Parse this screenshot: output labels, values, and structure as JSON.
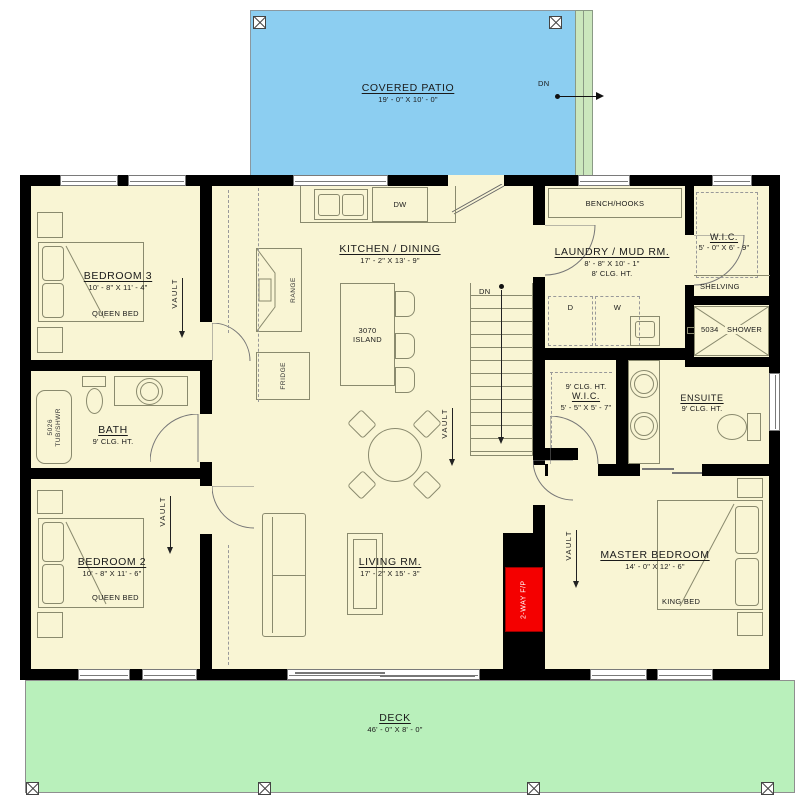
{
  "patio": {
    "name": "COVERED PATIO",
    "dims": "19' - 0\" X 10' - 0\"",
    "down_label": "DN"
  },
  "deck": {
    "name": "DECK",
    "dims": "46' - 0\" X 8' - 0\""
  },
  "house": {
    "bedroom3": {
      "name": "BEDROOM 3",
      "dims": "10' - 8\" X 11' - 4\"",
      "bed": "QUEEN BED"
    },
    "bath": {
      "name": "BATH",
      "ceiling": "9' CLG. HT.",
      "tub_model": "5026",
      "tub_type": "TUB/SHWR"
    },
    "bedroom2": {
      "name": "BEDROOM 2",
      "dims": "10' - 8\" X 11' - 6\"",
      "bed": "QUEEN BED"
    },
    "kitchen": {
      "name": "KITCHEN / DINING",
      "dims": "17' - 2\" X 13' - 9\"",
      "island_model": "3070",
      "island_label": "ISLAND",
      "dishwasher": "DW",
      "fridge": "FRIDGE",
      "range": "RANGE",
      "down_label": "DN"
    },
    "laundry": {
      "name": "LAUNDRY / MUD RM.",
      "dims": "8' - 8\" X 10' - 1\"",
      "ceiling": "8' CLG. HT.",
      "bench": "BENCH/HOOKS",
      "dryer": "D",
      "washer": "W"
    },
    "wic_hall": {
      "name": "W.I.C.",
      "dims": "5' - 0\" X 6' - 9\"",
      "shelving": "SHELVING"
    },
    "shower": {
      "model": "5034",
      "label": "SHOWER"
    },
    "ensuite": {
      "name": "ENSUITE",
      "ceiling": "9' CLG. HT."
    },
    "wic_master": {
      "ceiling": "9' CLG. HT.",
      "name": "W.I.C.",
      "dims": "5' - 5\" X 5' - 7\""
    },
    "living": {
      "name": "LIVING RM.",
      "dims": "17' - 2\" X 15' - 3\""
    },
    "master": {
      "name": "MASTER BEDROOM",
      "dims": "14' - 0\" X 12' - 6\"",
      "bed": "KING BED"
    },
    "fireplace": "2-WAY F/P",
    "vault": "VAULT"
  },
  "colors": {
    "patio_blue": "#8CCEF1",
    "deck_green": "#B9F0BB",
    "floor_yellow": "#F9F5D4",
    "wall_black": "#000000",
    "fireplace_red": "#F40000",
    "steps_green": "#CBE7BD"
  }
}
